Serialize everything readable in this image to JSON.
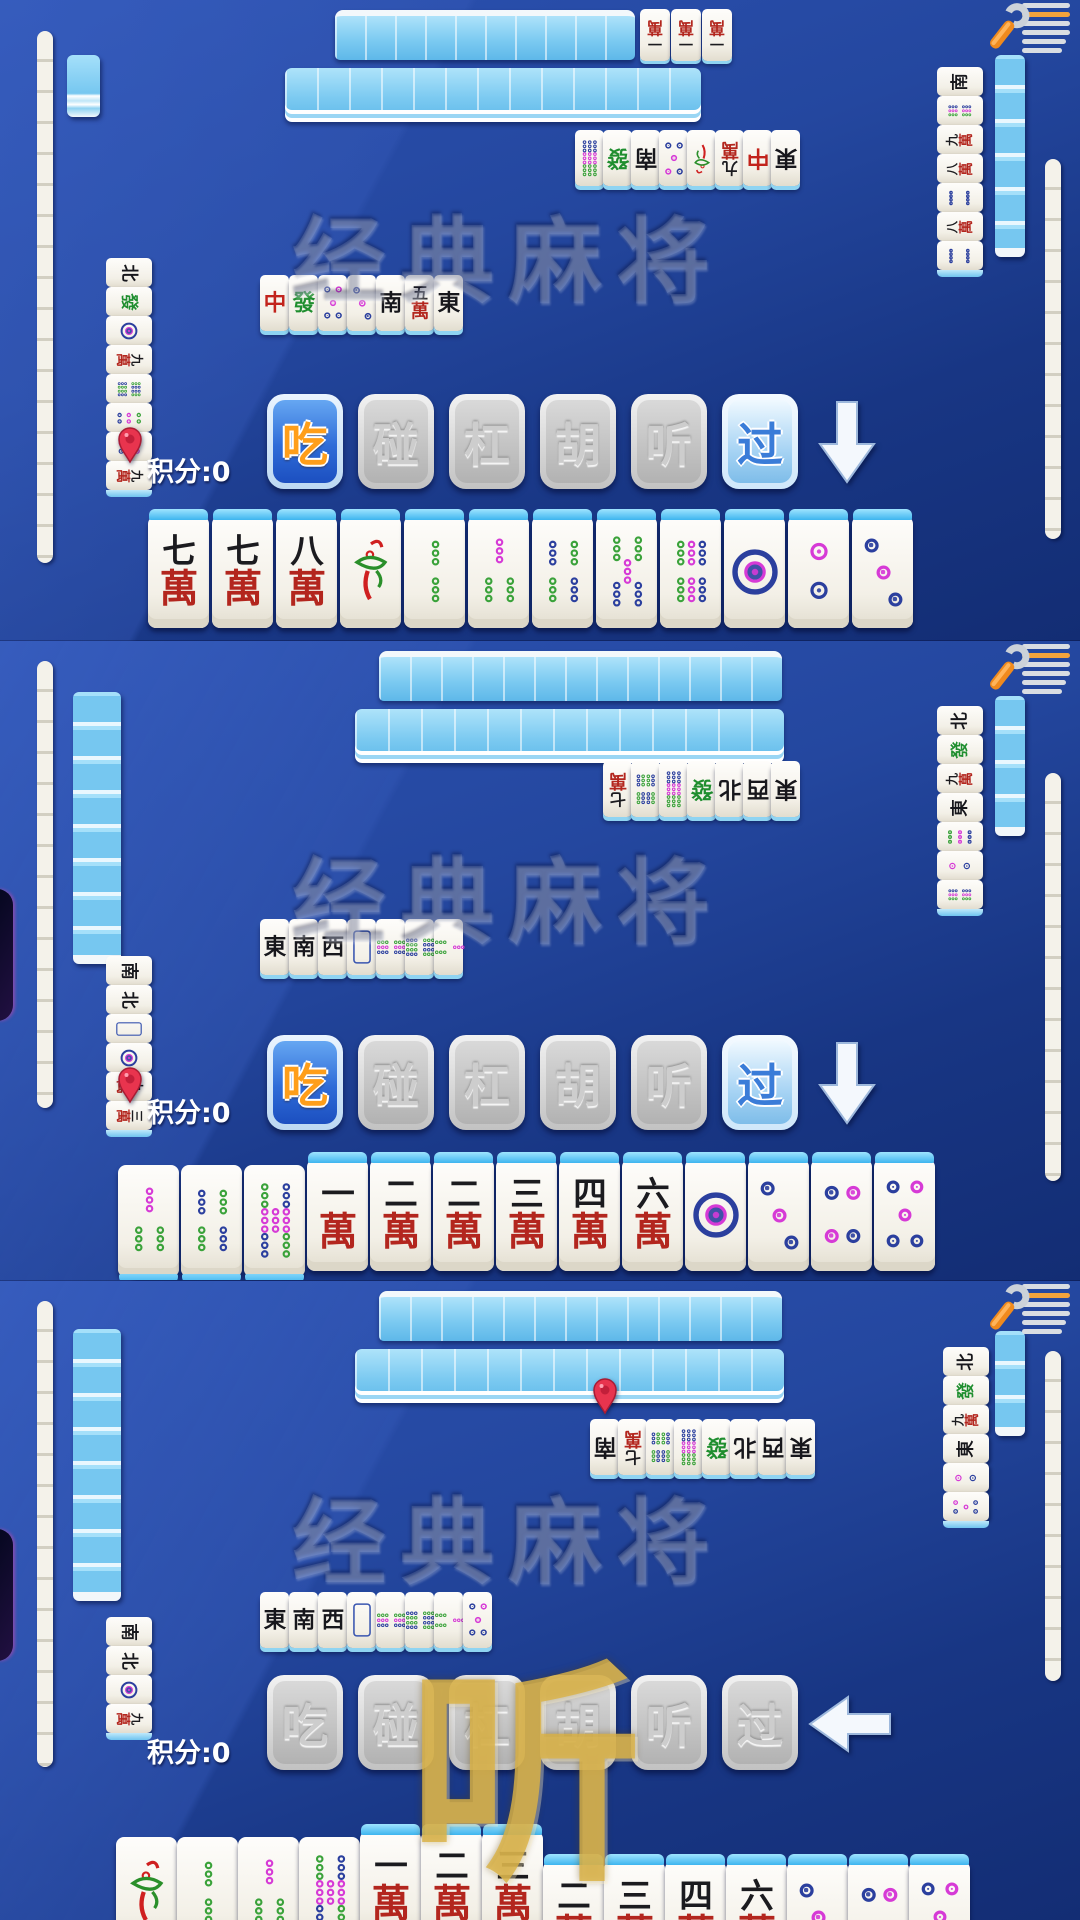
{
  "app": {
    "watermark": "经典麻将",
    "score_label": "积分:0"
  },
  "colors": {
    "background_dark": "#183684",
    "background_light": "#2c52b2",
    "tile_back_blue": "#7ccaf1",
    "tile_face": "#f3f0e7",
    "chi_button_bg": "#2f6cd8",
    "chi_button_text": "#ff9e1a",
    "guo_button_text": "#3a7cd8",
    "disabled_button_text": "#cdcdcd",
    "wan_red": "#b3261e",
    "dot_blue": "#2b3f9e",
    "dot_magenta": "#d63ad6",
    "dot_green": "#3aa23a",
    "pin_red": "#e8344e",
    "ting_gold": "#dbb246",
    "arrow_white": "#f4f8fd"
  },
  "icons": [
    "wrench-settings-icon",
    "last-discard-pin-icon",
    "down-arrow-icon",
    "left-arrow-icon"
  ],
  "panels": [
    {
      "top": {
        "wall_row1": 10,
        "meld": [
          "一萬",
          "一萬",
          "一萬"
        ],
        "wall_row2": 13,
        "discards": [
          "九条",
          "發",
          "南",
          "五筒",
          "一条",
          "九萬",
          "中",
          "東"
        ],
        "pin_index": -1
      },
      "left": {
        "wall": 14,
        "hand_backs": 1,
        "discards": [
          "北",
          "發",
          "一筒",
          "九萬",
          "八条",
          "六筒",
          "四筒",
          "九萬"
        ],
        "pin_index": 6
      },
      "right": {
        "discards": [
          "南",
          "六条",
          "九萬",
          "八萬",
          "八筒",
          "八萬",
          "八筒"
        ],
        "hand_backs": 6,
        "wall": 12
      },
      "center_discards": [
        "中",
        "發",
        "五筒",
        "三筒",
        "南",
        "五萬",
        "東"
      ],
      "center_sideways": [],
      "buttons": [
        {
          "label": "吃",
          "state": "chi"
        },
        {
          "label": "碰",
          "state": "disabled"
        },
        {
          "label": "杠",
          "state": "disabled"
        },
        {
          "label": "胡",
          "state": "disabled"
        },
        {
          "label": "听",
          "state": "disabled"
        },
        {
          "label": "过",
          "state": "guo"
        }
      ],
      "arrow": "down",
      "hand": [
        "七萬",
        "七萬",
        "八萬",
        "一条",
        "二条",
        "三条",
        "四条",
        "五条",
        "六条",
        "一筒",
        "二筒",
        "三筒"
      ],
      "hand_style": {
        "low": [],
        "dropped": []
      },
      "score": "积分:0",
      "overlay": null
    },
    {
      "top": {
        "wall_row1": 13,
        "meld": [],
        "wall_row2": 13,
        "discards": [
          "七萬",
          "八条",
          "九条",
          "發",
          "北",
          "西",
          "東"
        ],
        "pin_index": -1
      },
      "left": {
        "wall": 14,
        "hand_backs": 8,
        "discards": [
          "南",
          "北",
          "白",
          "一筒",
          "九萬",
          "三萬"
        ],
        "pin_index": 4
      },
      "right": {
        "discards": [
          "北",
          "發",
          "九萬",
          "東",
          "九筒",
          "二筒",
          "六条"
        ],
        "hand_backs": 4,
        "wall": 13
      },
      "center_discards": [
        "東",
        "南",
        "西",
        "白",
        "六条",
        "八条",
        "三条"
      ],
      "center_sideways": [
        4,
        5,
        6
      ],
      "buttons": [
        {
          "label": "吃",
          "state": "chi"
        },
        {
          "label": "碰",
          "state": "disabled"
        },
        {
          "label": "杠",
          "state": "disabled"
        },
        {
          "label": "胡",
          "state": "disabled"
        },
        {
          "label": "听",
          "state": "disabled"
        },
        {
          "label": "过",
          "state": "guo"
        }
      ],
      "arrow": "down",
      "hand": [
        "三条",
        "四条",
        "七条",
        "一萬",
        "二萬",
        "二萬",
        "三萬",
        "四萬",
        "六萬",
        "一筒",
        "三筒",
        "四筒",
        "五筒"
      ],
      "hand_style": {
        "low": [
          0,
          1,
          2
        ],
        "dropped": []
      },
      "score": "积分:0",
      "overlay": null
    },
    {
      "top": {
        "wall_row1": 13,
        "meld": [],
        "wall_row2": 13,
        "discards": [
          "南",
          "七萬",
          "八条",
          "九条",
          "發",
          "北",
          "西",
          "東"
        ],
        "pin_index": 0
      },
      "left": {
        "wall": 14,
        "hand_backs": 8,
        "discards": [
          "南",
          "北",
          "一筒",
          "九萬"
        ],
        "pin_index": -1
      },
      "right": {
        "discards": [
          "北",
          "發",
          "九萬",
          "東",
          "二筒",
          "五筒"
        ],
        "hand_backs": 3,
        "wall": 10
      },
      "center_discards": [
        "東",
        "南",
        "西",
        "白",
        "六条",
        "八条",
        "三条",
        "五筒"
      ],
      "center_sideways": [
        4,
        5,
        6
      ],
      "buttons": [
        {
          "label": "吃",
          "state": "disabled"
        },
        {
          "label": "碰",
          "state": "disabled"
        },
        {
          "label": "杠",
          "state": "disabled"
        },
        {
          "label": "胡",
          "state": "disabled"
        },
        {
          "label": "听",
          "state": "disabled"
        },
        {
          "label": "过",
          "state": "disabled"
        }
      ],
      "arrow": "left",
      "hand": [
        "一条",
        "二条",
        "三条",
        "七条",
        "一萬",
        "二萬",
        "三萬",
        "二萬",
        "三萬",
        "四萬",
        "六萬",
        "三筒",
        "四筒",
        "五筒"
      ],
      "hand_style": {
        "low": [
          0,
          1,
          2,
          3
        ],
        "dropped": [
          7,
          8,
          9,
          10,
          11,
          12,
          13
        ]
      },
      "score": "积分:0",
      "overlay": "听"
    }
  ]
}
